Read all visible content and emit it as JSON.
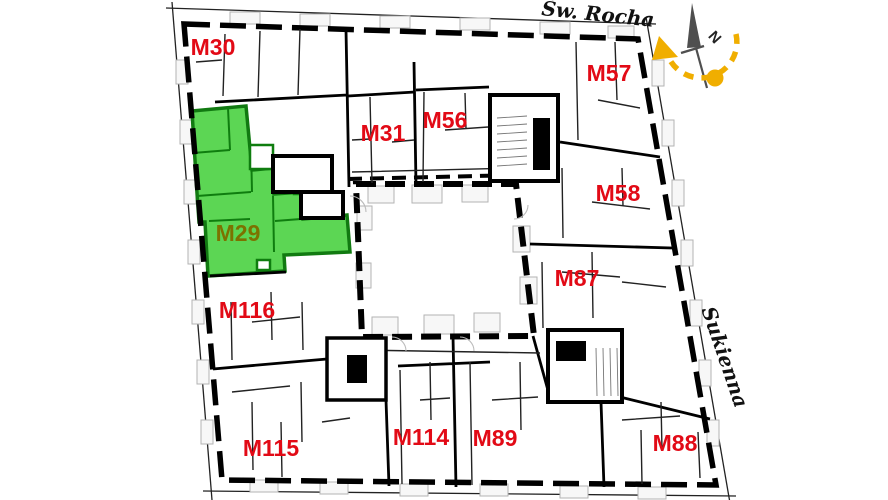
{
  "plan": {
    "type": "apartment-floor-plan",
    "selected_unit": "M29"
  },
  "streets": [
    {
      "name": "Św. Rocha",
      "position": "top"
    },
    {
      "name": "Sukienna",
      "position": "right"
    }
  ],
  "units": [
    {
      "id": "M30",
      "highlighted": false
    },
    {
      "id": "M31",
      "highlighted": false
    },
    {
      "id": "M56",
      "highlighted": false
    },
    {
      "id": "M57",
      "highlighted": false
    },
    {
      "id": "M58",
      "highlighted": false
    },
    {
      "id": "M87",
      "highlighted": false
    },
    {
      "id": "M88",
      "highlighted": false
    },
    {
      "id": "M89",
      "highlighted": false
    },
    {
      "id": "M114",
      "highlighted": false
    },
    {
      "id": "M115",
      "highlighted": false
    },
    {
      "id": "M116",
      "highlighted": false
    },
    {
      "id": "M29",
      "highlighted": true
    }
  ],
  "compass": {
    "north_label": "N"
  },
  "colors": {
    "unit_label": "#e20a16",
    "highlight_fill": "#5cd654",
    "highlight_label": "#7c7200",
    "compass_accent": "#f0ae00",
    "wall": "#000000"
  }
}
